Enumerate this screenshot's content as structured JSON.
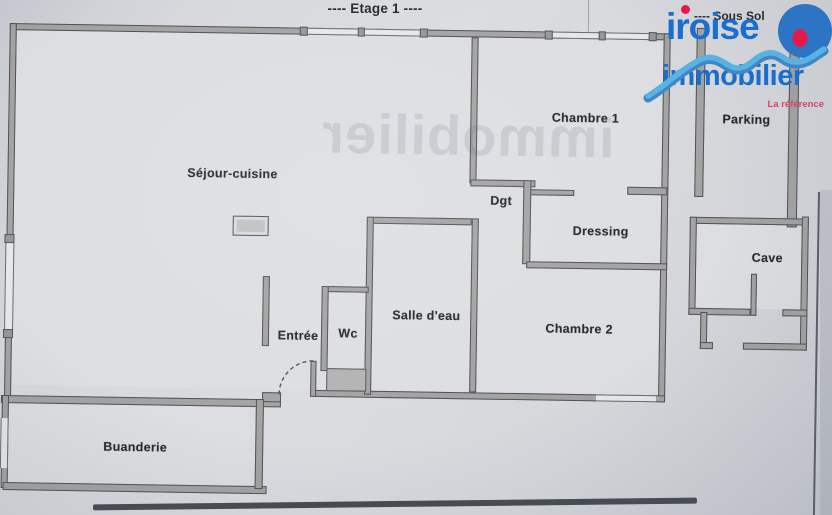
{
  "page": {
    "floor_title": "---- Etage 1 ----",
    "basement_title": "---- Sous Sol",
    "watermark": "immobilier"
  },
  "rooms": {
    "sejour": "Séjour-cuisine",
    "chambre1": "Chambre 1",
    "dgt": "Dgt",
    "dressing": "Dressing",
    "salle_eau": "Salle d'eau",
    "chambre2": "Chambre 2",
    "entree": "Entrée",
    "wc": "Wc",
    "buanderie": "Buanderie",
    "parking": "Parking",
    "cave": "Cave"
  },
  "logo": {
    "name_line1": "iroise",
    "name_line2": "immobilier",
    "tagline": "La référence"
  },
  "colors": {
    "logo_blue": "#1a6ed0",
    "wave_light": "#58b2e2",
    "wave_dark": "#3e88c8",
    "disc_blue": "#2e74c4",
    "dot_red": "#e8194a",
    "tagline_red": "#d6456a",
    "wall_fill": "#a2a3a2",
    "wall_line": "#515254",
    "paper": "#d2d5da",
    "ink": "#26282c"
  }
}
